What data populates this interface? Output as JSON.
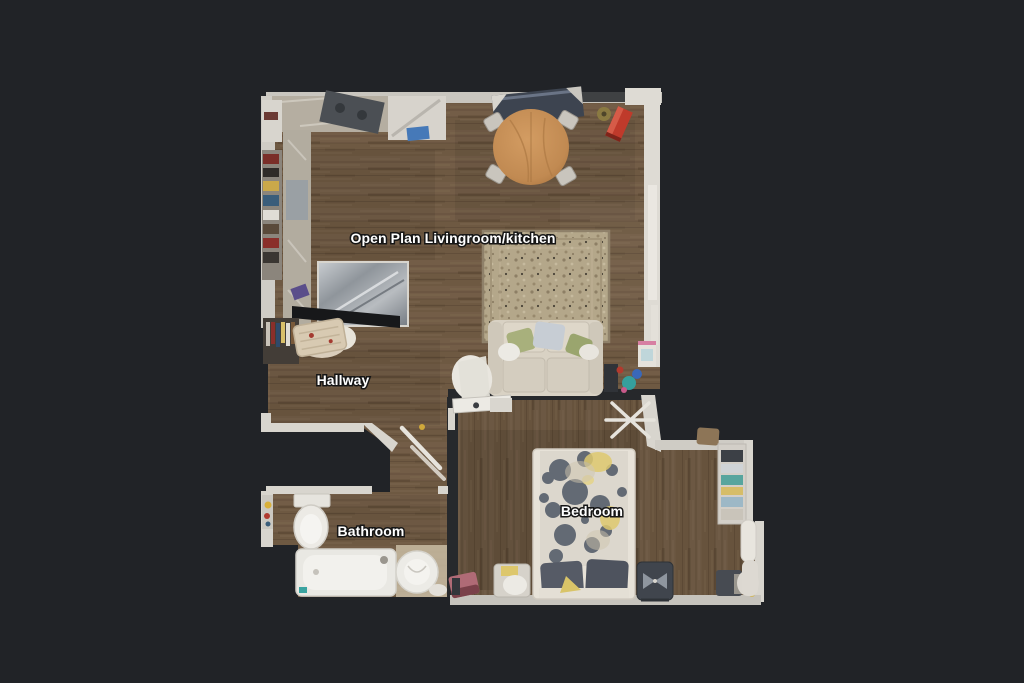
{
  "view": {
    "name": "floor-plan-top-down-view",
    "background_color": "#212327"
  },
  "rooms": [
    {
      "id": "open-plan-livingroom-kitchen",
      "label": "Open Plan Livingroom/kitchen"
    },
    {
      "id": "hallway",
      "label": "Hallway"
    },
    {
      "id": "bathroom",
      "label": "Bathroom"
    },
    {
      "id": "bedroom",
      "label": "Bedroom"
    }
  ],
  "palette": {
    "background": "#212327",
    "floor_wood": "#6e5942",
    "floor_wood_dark": "#5b4835",
    "wall_light": "#d8d5ce",
    "wall_dark_shadow": "#26282b",
    "rug": "#b4a78a",
    "sofa": "#d9d2c4",
    "bed_duvet": "#dcd7cd",
    "bed_blob_gray": "#59616d",
    "bed_accent_yellow": "#dfca70",
    "bathtub": "#e9e8e3",
    "dining_table": "#c18a52",
    "red_case": "#bf3a2b",
    "label_text": "#ffffff",
    "label_outline": "#161616"
  },
  "depicted_objects": [
    "kitchen-counters",
    "hob",
    "fridge",
    "dining-table",
    "dining-chairs",
    "sideboard",
    "red-case",
    "area-rug",
    "sofa",
    "throw-pillows",
    "radiator",
    "shoe-rack",
    "basket",
    "toilet",
    "bathtub",
    "sink",
    "bed",
    "pillows",
    "drying-rack",
    "wardrobe",
    "office-chair",
    "bedside-chair"
  ]
}
